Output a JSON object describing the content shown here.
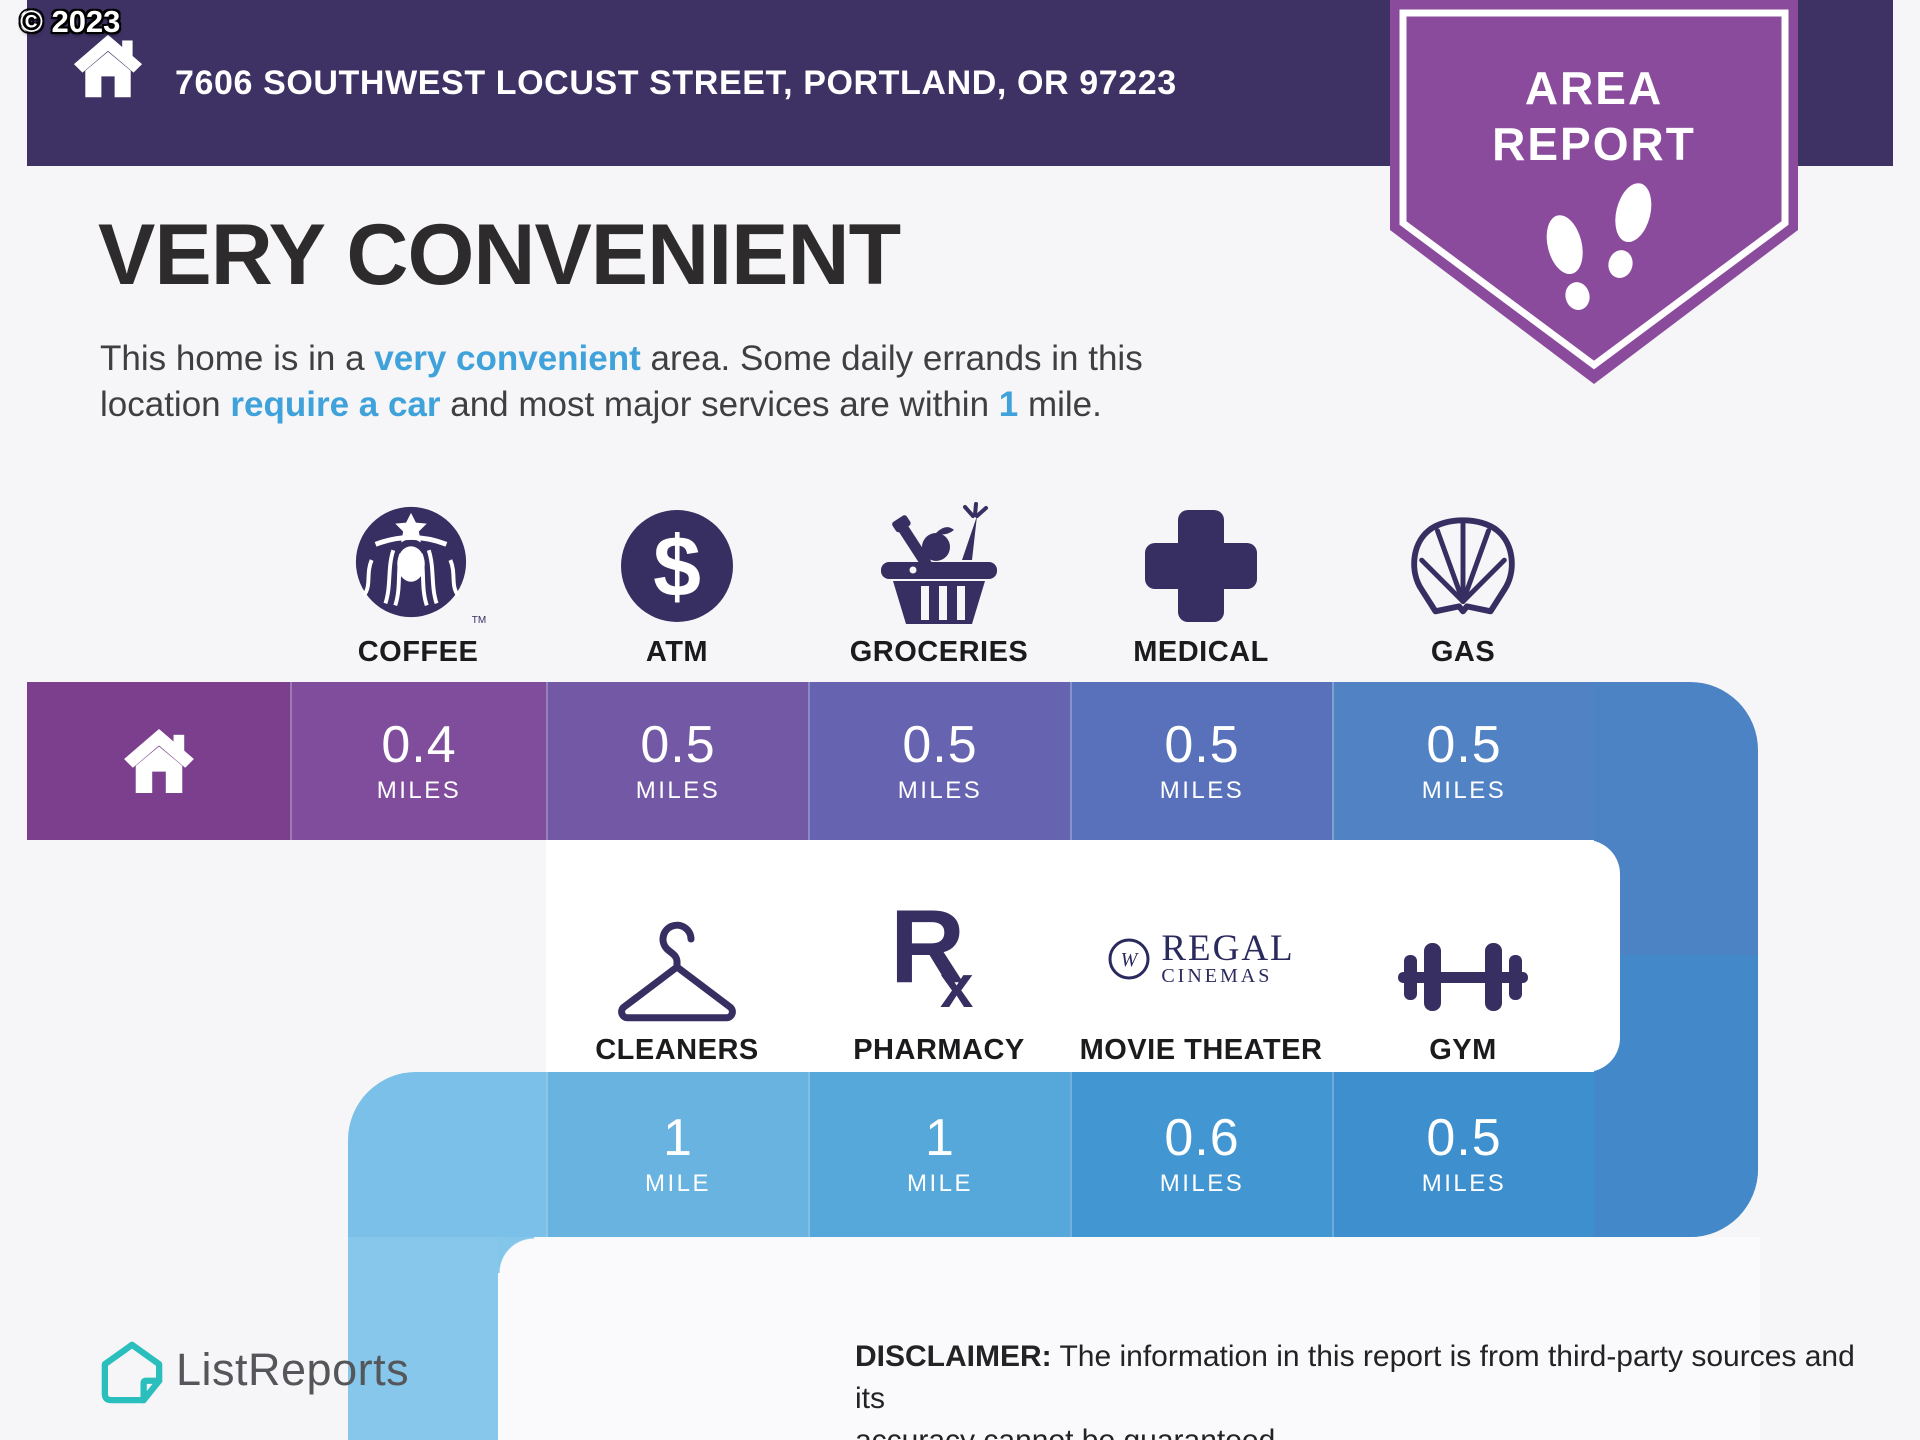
{
  "copyright": "© 2023",
  "top_bar": {
    "address": "7606 SOUTHWEST LOCUST STREET, PORTLAND, OR 97223"
  },
  "badge": {
    "line1": "AREA",
    "line2": "REPORT"
  },
  "headline": "VERY CONVENIENT",
  "summary": {
    "s1": "This home is in a ",
    "s2": "very convenient",
    "s3": " area. Some daily errands in this",
    "s4": "location ",
    "s5": "require a car",
    "s6": " and most major services are within ",
    "s7": "1",
    "s8": " mile."
  },
  "amenities_row1": [
    {
      "id": "coffee",
      "label": "COFFEE",
      "value": "0.4",
      "unit": "MILES",
      "icon": "starbucks-siren-icon",
      "cell_color": "#7F4D9B"
    },
    {
      "id": "atm",
      "label": "ATM",
      "value": "0.5",
      "unit": "MILES",
      "icon": "dollar-circle-icon",
      "cell_color": "#7358A5"
    },
    {
      "id": "groceries",
      "label": "GROCERIES",
      "value": "0.5",
      "unit": "MILES",
      "icon": "grocery-basket-icon",
      "cell_color": "#6663B0"
    },
    {
      "id": "medical",
      "label": "MEDICAL",
      "value": "0.5",
      "unit": "MILES",
      "icon": "medical-cross-icon",
      "cell_color": "#5971BA"
    },
    {
      "id": "gas",
      "label": "GAS",
      "value": "0.5",
      "unit": "MILES",
      "icon": "shell-icon",
      "cell_color": "#5082C4"
    }
  ],
  "amenities_row2": [
    {
      "id": "cleaners",
      "label": "CLEANERS",
      "value": "1",
      "unit": "MILE",
      "icon": "hanger-icon",
      "cell_color": "#69B3E1"
    },
    {
      "id": "pharmacy",
      "label": "PHARMACY",
      "value": "1",
      "unit": "MILE",
      "icon": "rx-icon",
      "cell_color": "#57A8DA"
    },
    {
      "id": "movie_theater",
      "label": "MOVIE THEATER",
      "value": "0.6",
      "unit": "MILES",
      "icon": "regal-cinemas-logo",
      "cell_color": "#4296D2"
    },
    {
      "id": "gym",
      "label": "GYM",
      "value": "0.5",
      "unit": "MILES",
      "icon": "dumbbell-icon",
      "cell_color": "#3D8FCE"
    }
  ],
  "icons": {
    "dollar_symbol": "$",
    "rx_r": "R",
    "rx_x": "x",
    "starbucks_tm": "TM",
    "regal_w": "W"
  },
  "movie_logo": {
    "line1": "REGAL",
    "line2": "CINEMAS"
  },
  "footer": {
    "brand": "ListReports",
    "disclaimer_label": "DISCLAIMER:",
    "disclaimer_line1": " The information in this report is from third-party sources and its",
    "disclaimer_line2": "accuracy cannot be guaranteed."
  },
  "colors": {
    "background": "#F6F5F7",
    "top_bar": "#3E3163",
    "badge_purple": "#8A4B9D",
    "highlight_blue": "#3FA2DA",
    "icon_purple": "#372E62",
    "regal_navy": "#2B2A5E",
    "brand_teal": "#2ABFBC",
    "home_cell": "#7C3F8E",
    "connector_upper": "#4C83C4",
    "connector_lower": "#4389CA",
    "band2_curve_cell": "#7BC0E8",
    "left_strip": "#87C7EB"
  }
}
